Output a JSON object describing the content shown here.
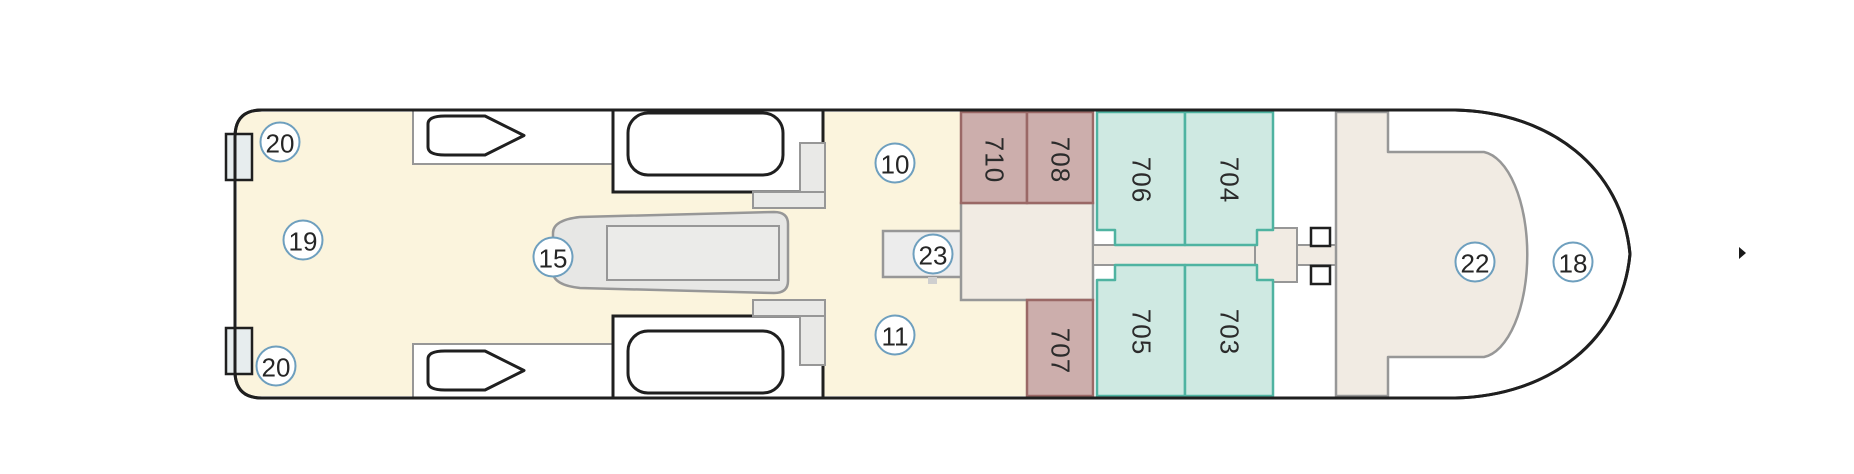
{
  "deck_plan": {
    "markers": [
      {
        "label": "20"
      },
      {
        "label": "19"
      },
      {
        "label": "20"
      },
      {
        "label": "15"
      },
      {
        "label": "10"
      },
      {
        "label": "23"
      },
      {
        "label": "11"
      },
      {
        "label": "22"
      },
      {
        "label": "18"
      }
    ],
    "cabins": [
      {
        "number": "710",
        "group": "pink"
      },
      {
        "number": "708",
        "group": "pink"
      },
      {
        "number": "706",
        "group": "teal"
      },
      {
        "number": "704",
        "group": "teal"
      },
      {
        "number": "707",
        "group": "pink"
      },
      {
        "number": "705",
        "group": "teal"
      },
      {
        "number": "703",
        "group": "teal"
      }
    ],
    "colors": {
      "deck_cream": "#fbf4dd",
      "interior_beige": "#f1ebe3",
      "cabin_pink_fill": "#ccaeac",
      "cabin_pink_border": "#9a6866",
      "cabin_teal_fill": "#cfe9e2",
      "cabin_teal_border": "#4fb3a1",
      "hull_outline": "#1f1f1f",
      "detail_gray": "#979797",
      "detail_gray_fill": "#e9e9e7",
      "marker_ring": "#6e9fbe",
      "platform_fill": "#e7edee"
    }
  }
}
